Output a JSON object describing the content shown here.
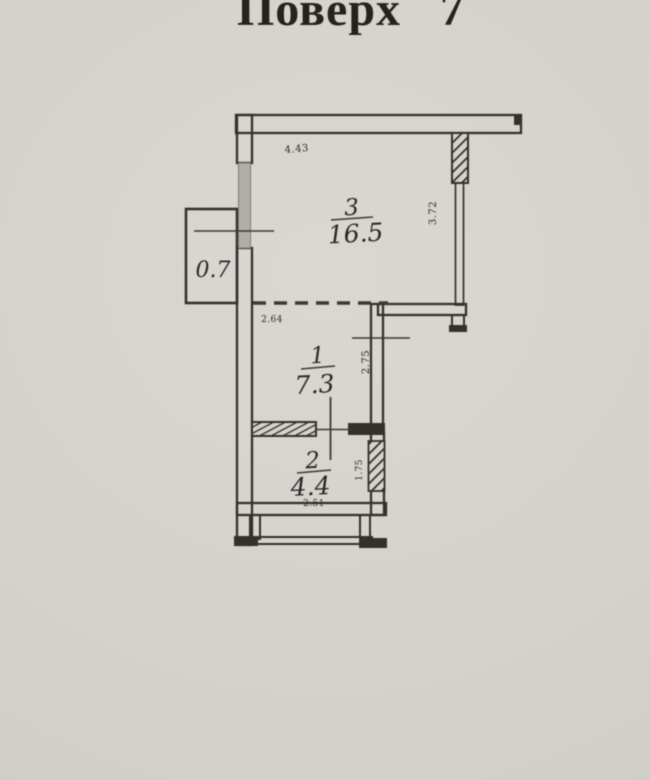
{
  "title": "Поверх 7",
  "plan": {
    "rooms": [
      {
        "number": "3",
        "area": "16.5",
        "width": "4.43",
        "height": "3.72"
      },
      {
        "number": "1",
        "area": "7.3",
        "width": "2.64",
        "height": "2.75"
      },
      {
        "number": "2",
        "area": "4.4",
        "width": "2.51",
        "height": "1.75"
      }
    ],
    "balcony_area": "0.7",
    "colors": {
      "background": "#d6d3ce",
      "wall_line": "#34312d",
      "text": "#2b2825",
      "window_shade": "#b2aea7"
    }
  }
}
